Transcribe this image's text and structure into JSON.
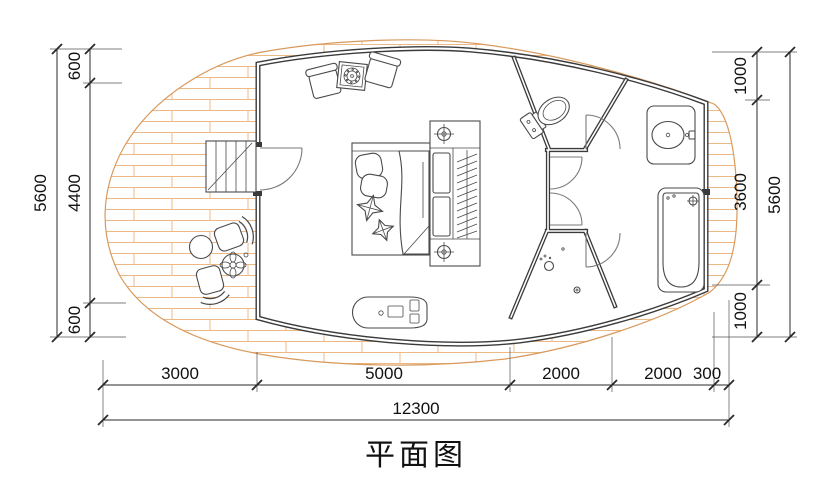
{
  "title": "平面图",
  "colors": {
    "wall": "#3a3a3a",
    "furniture_line": "#4a4a4a",
    "deck_plank": "#ecb884",
    "deck_edge": "#d9995c",
    "dimension_line": "#2a2a2a",
    "text": "#111111",
    "background": "#ffffff"
  },
  "dimensions": {
    "left": {
      "total": "5600",
      "segments": [
        "600",
        "4400",
        "600"
      ]
    },
    "right": {
      "total": "5600",
      "segments": [
        "1000",
        "3600",
        "1000"
      ]
    },
    "bottom": {
      "total": "12300",
      "segments": [
        "3000",
        "5000",
        "2000",
        "2000",
        "300"
      ]
    }
  }
}
